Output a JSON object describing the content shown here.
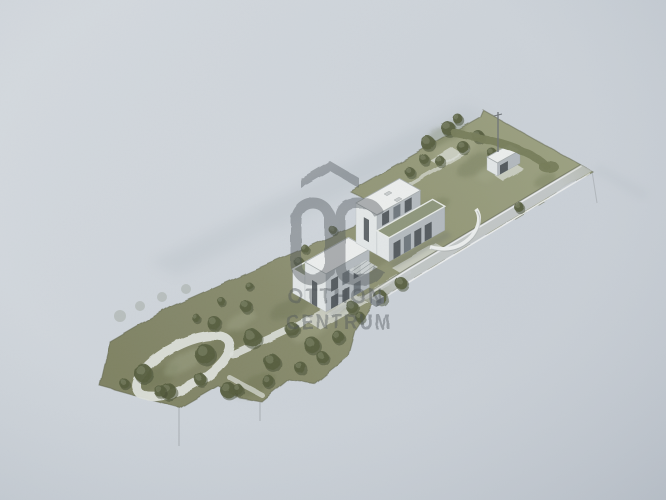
{
  "image": {
    "kind": "photograph of a printed architectural rendering",
    "view": "isometric site plan",
    "subject": "two modern flat-roof houses on a long narrow plot with garden paths, trees, a garage outbuilding and a street along the lower edge"
  },
  "watermark": {
    "brand_line1": "OTTHON",
    "brand_line2": "CENTRUM",
    "logo": "roof-chevron-oc-monogram"
  },
  "colors": {
    "paper": "#cdd3d9",
    "paperLight": "#d9dee2",
    "paperDark": "#c2c9d1",
    "grass": "#878a6b",
    "grassDark": "#6b7050",
    "grassLight": "#a3a88a",
    "tree": "#555d3e",
    "treeDark": "#434a2f",
    "pathWhite": "#dde0da",
    "road": "#c5cacc",
    "curb": "#eef0f0",
    "roofWhite": "#eceeed",
    "roofGreen": "#8d957a",
    "wallLight": "#e3e7e7",
    "wallShadow": "#b3b9bd",
    "windowDark": "#3e4448",
    "fence": "#5d6149",
    "watermark": "#4b5156",
    "ghost": "#bdc5cb",
    "hairline": "#85898d"
  },
  "scene": {
    "trees": [
      [
        143,
        373,
        9
      ],
      [
        168,
        391,
        8
      ],
      [
        205,
        354,
        10
      ],
      [
        228,
        390,
        8
      ],
      [
        214,
        323,
        7
      ],
      [
        252,
        338,
        9
      ],
      [
        272,
        362,
        8
      ],
      [
        292,
        329,
        7
      ],
      [
        246,
        306,
        6
      ],
      [
        312,
        345,
        8
      ],
      [
        322,
        357,
        6
      ],
      [
        196,
        318,
        4
      ],
      [
        221,
        301,
        4
      ],
      [
        249,
        286,
        4
      ],
      [
        305,
        249,
        4
      ],
      [
        333,
        230,
        4
      ],
      [
        384,
        195,
        4
      ],
      [
        299,
        262,
        5
      ],
      [
        428,
        143,
        7
      ],
      [
        448,
        128,
        7
      ],
      [
        463,
        147,
        6
      ],
      [
        478,
        136,
        6
      ],
      [
        440,
        161,
        5
      ],
      [
        492,
        153,
        5
      ],
      [
        424,
        159,
        5
      ],
      [
        458,
        119,
        5
      ],
      [
        410,
        172,
        5
      ],
      [
        380,
        297,
        7
      ],
      [
        401,
        283,
        6
      ],
      [
        300,
        367,
        6
      ],
      [
        338,
        337,
        6
      ],
      [
        360,
        317,
        5
      ],
      [
        519,
        207,
        5
      ],
      [
        268,
        381,
        6
      ],
      [
        238,
        389,
        5
      ],
      [
        200,
        379,
        6
      ],
      [
        160,
        391,
        6
      ],
      [
        124,
        383,
        5
      ],
      [
        352,
        307,
        6
      ]
    ],
    "ghost_trees": [
      [
        120,
        316,
        6
      ],
      [
        140,
        306,
        5
      ],
      [
        162,
        297,
        5
      ],
      [
        186,
        289,
        5
      ]
    ]
  }
}
